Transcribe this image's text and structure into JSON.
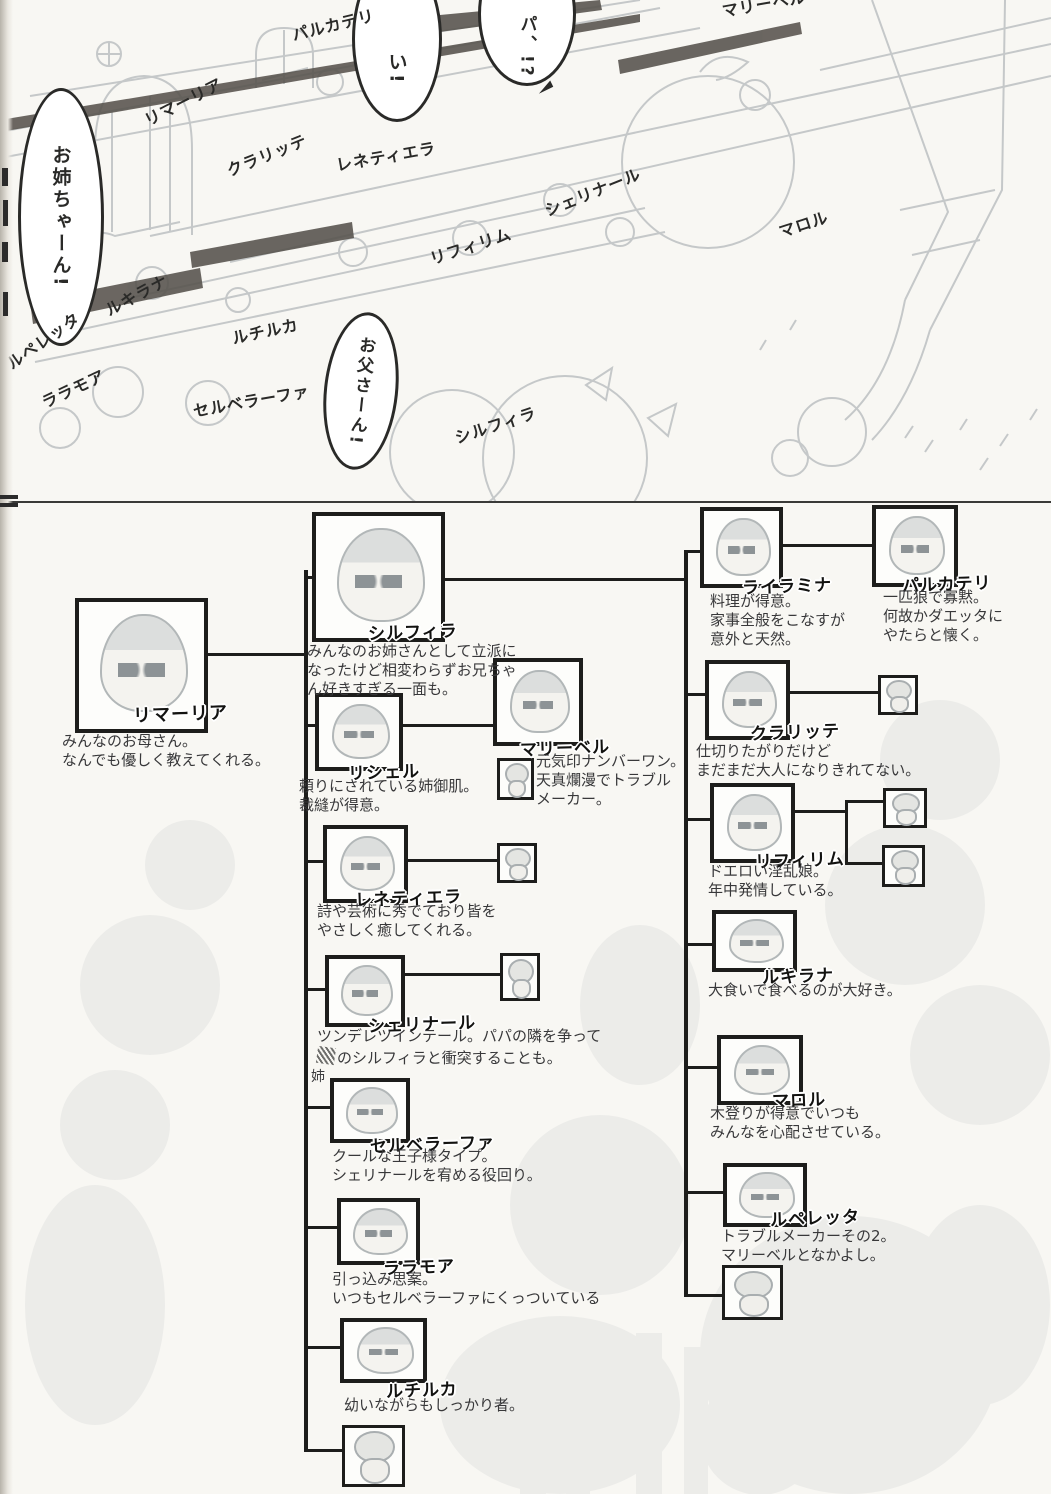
{
  "scene": {
    "bubbles": {
      "oneechan": "お姉ちゃーん!",
      "i": "い!",
      "papa": "パ、!?",
      "otousan": "お父さーん!"
    },
    "name_labels": [
      "リマーリア",
      "パルカテリ",
      "クラリッテ",
      "レネティエラ",
      "シェリナール",
      "リフィリム",
      "マリーベル",
      "マロル",
      "ルキラナ",
      "ルペレッタ",
      "ルチルカ",
      "ララモア",
      "セルベラーファ",
      "シルフィラ"
    ]
  },
  "chart": {
    "mother": {
      "name": "リマーリア",
      "desc": "みんなのお母さん。\nなんでも優しく教えてくれる。"
    },
    "left_members": [
      {
        "name": "シルフィラ",
        "desc": "みんなのお姉さんとして立派に\nなったけど相変わらずお兄ちゃ\nん好きすぎる一面も。"
      },
      {
        "name": "リシェル",
        "desc": "頼りにされている姉御肌。\n裁縫が得意。"
      },
      {
        "name": "マリーベル",
        "desc": "元気印ナンバーワン。\n天真爛漫でトラブル\nメーカー。"
      },
      {
        "name": "レネティエラ",
        "desc": "詩や芸術に秀でており皆を\nやさしく癒してくれる。"
      },
      {
        "name": "シェリナール",
        "desc": "ツンデレツインテール。パパの隣を争って",
        "desc2": "のシルフィラと衝突することも。",
        "correction": "姉"
      },
      {
        "name": "セルベラーファ",
        "desc": "クールな王子様タイプ。\nシェリナールを宥める役回り。"
      },
      {
        "name": "ララモア",
        "desc": "引っ込み思案。\nいつもセルベラーファにくっついている"
      },
      {
        "name": "ルチルカ",
        "desc": "幼いながらもしっかり者。"
      }
    ],
    "right_members": [
      {
        "name": "ライラミナ",
        "desc": "料理が得意。\n家事全般をこなすが\n意外と天然。"
      },
      {
        "name": "パルカテリ",
        "desc": "一匹狼で寡黙。\n何故かダエッタに\nやたらと懐く。"
      },
      {
        "name": "クラリッテ",
        "desc": "仕切りたがりだけど\nまだまだ大人になりきれてない。"
      },
      {
        "name": "リフィリム",
        "desc": "ドエロい淫乱娘。\n年中発情している。"
      },
      {
        "name": "ルキラナ",
        "desc": "大食いで食べるのが大好き。"
      },
      {
        "name": "マロル",
        "desc": "木登りが得意でいつも\nみんなを心配させている。"
      },
      {
        "name": "ルペレッタ",
        "desc": "トラブルメーカーその2。\nマリーベルとなかよし。"
      }
    ]
  }
}
